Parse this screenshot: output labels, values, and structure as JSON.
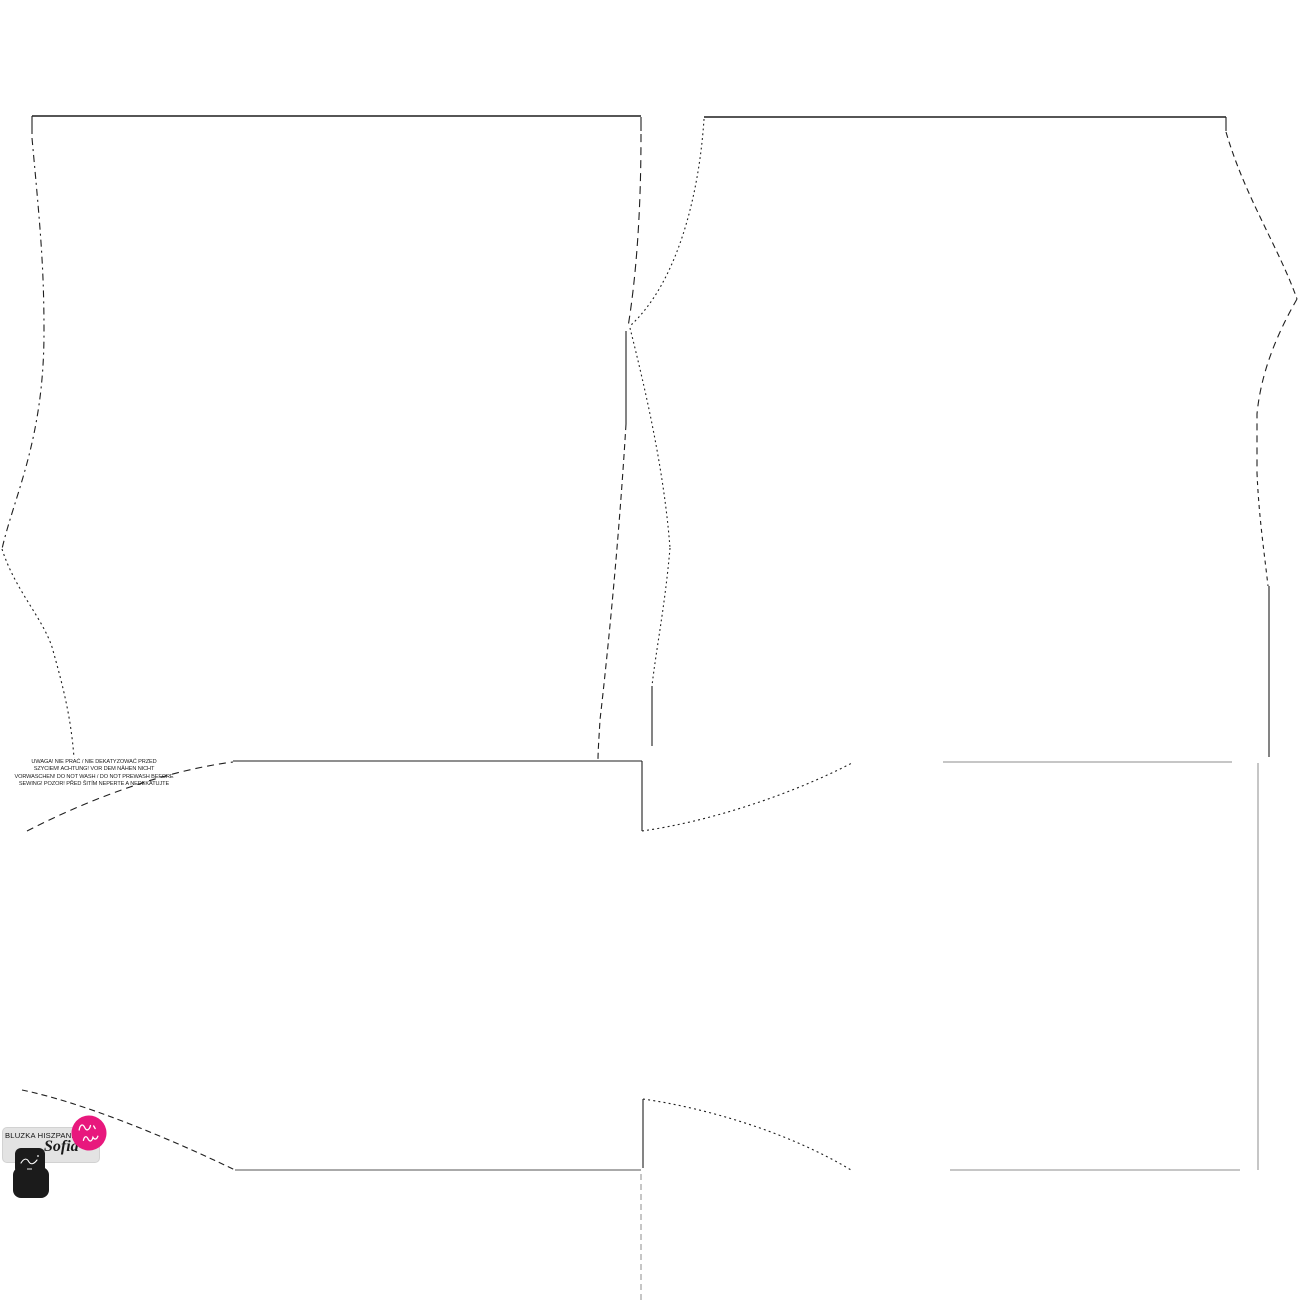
{
  "page": {
    "background": "#ffffff",
    "width": 1300,
    "height": 1300
  },
  "warning": {
    "lines": [
      "UWAGA! NIE PRAĆ / NIE DEKATYZOWAĆ PRZED",
      "SZYCIEM! ACHTUNG! VOR DEM NÄHEN NICHT",
      "VORWASCHEN! DO NOT WASH / DO NOT PREWASH BEFORE",
      "SEWING! POZOR! PŘED ŠITÍM NEPERTE A NEDEKATUJTE"
    ]
  },
  "label": {
    "title": "BLUZKA HISZPANKA",
    "name_script": "Sofia"
  },
  "colors": {
    "outline": "#1f1f1f",
    "faint_outline": "#8d8d8d",
    "label_bg": "#e3e3e3",
    "badge_pink": "#e8187d",
    "emblem_black": "#1b1b1b"
  }
}
